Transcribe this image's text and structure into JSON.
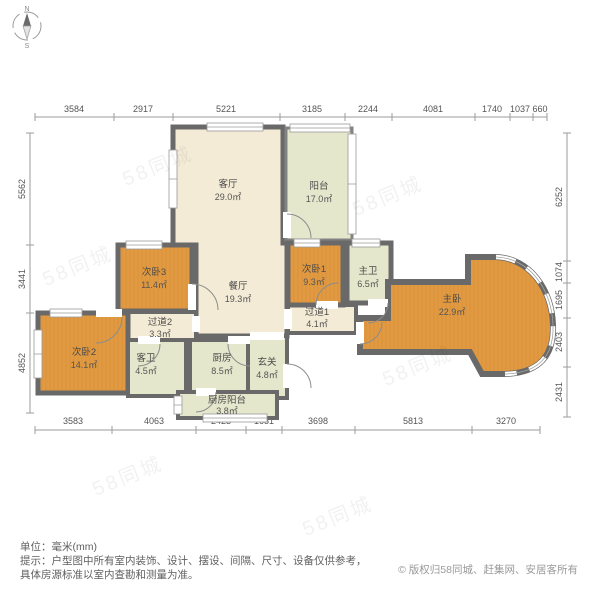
{
  "compass": {
    "north": "N",
    "south": "S"
  },
  "rooms": [
    {
      "id": "living",
      "name": "客厅",
      "area": "29.0㎡"
    },
    {
      "id": "balcony",
      "name": "阳台",
      "area": "17.0㎡"
    },
    {
      "id": "bedroom3",
      "name": "次卧3",
      "area": "11.4㎡"
    },
    {
      "id": "dining",
      "name": "餐厅",
      "area": "19.3㎡"
    },
    {
      "id": "bedroom1",
      "name": "次卧1",
      "area": "9.3㎡"
    },
    {
      "id": "master-bath",
      "name": "主卫",
      "area": "6.5㎡"
    },
    {
      "id": "master-bedroom",
      "name": "主卧",
      "area": "22.9㎡"
    },
    {
      "id": "bedroom2",
      "name": "次卧2",
      "area": "14.1㎡"
    },
    {
      "id": "hallway2",
      "name": "过道2",
      "area": "3.3㎡"
    },
    {
      "id": "hallway1",
      "name": "过道1",
      "area": "4.1㎡"
    },
    {
      "id": "guest-bath",
      "name": "客卫",
      "area": "4.5㎡"
    },
    {
      "id": "kitchen",
      "name": "厨房",
      "area": "8.5㎡"
    },
    {
      "id": "entry",
      "name": "玄关",
      "area": "4.8㎡"
    },
    {
      "id": "kitchen-balcony",
      "name": "厨房阳台",
      "area": "3.8㎡"
    }
  ],
  "dimensions_mm": {
    "top": [
      "3584",
      "2917",
      "5221",
      "3185",
      "2244",
      "4081",
      "1740",
      "1037",
      "660"
    ],
    "bottom": [
      "3583",
      "4063",
      "2423",
      "1651",
      "3698",
      "5813",
      "3270"
    ],
    "left": [
      "5562",
      "3441",
      "4852"
    ],
    "right": [
      "6252",
      "1074",
      "1695",
      "2403",
      "2431"
    ]
  },
  "footer": {
    "unit_label": "单位：毫米(mm)",
    "tip_line1": "提示：户型图中所有室内装饰、设计、摆设、间隔、尺寸、设备仅供参考，",
    "tip_line2": "具体房源标准以室内查勘和测量为准。",
    "copyright": "© 版权归58同城、赶集网、安居客所有"
  },
  "watermark": "58同城",
  "colors": {
    "wall": "#696969",
    "wood_floor": "#e19a42",
    "marble_floor": "#f4ebd6",
    "tile_floor": "#e5e7cc",
    "dimension": "#999999"
  }
}
